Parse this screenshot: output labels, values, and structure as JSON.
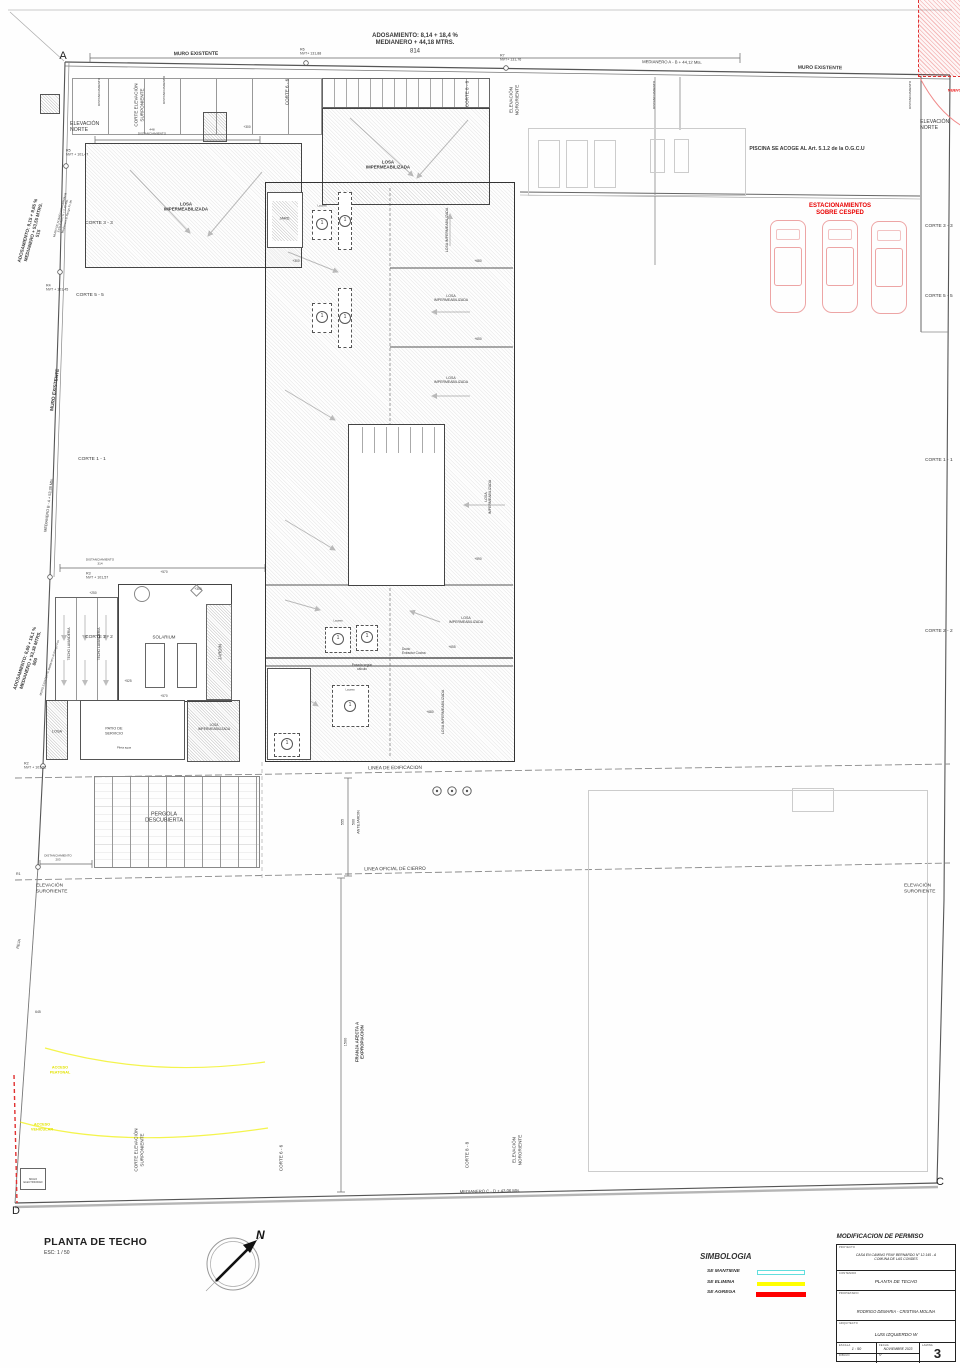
{
  "sheet": {
    "plan_title": "PLANTA DE TECHO",
    "plan_scale": "ESC: 1 / 50",
    "compass_n": "N",
    "corner_markers": {
      "a": "A",
      "c": "C",
      "d": "D"
    }
  },
  "legend": {
    "title": "SIMBOLOGIA",
    "items": [
      {
        "label": "SE MANTIENE",
        "color": "#62dede",
        "style": "outline"
      },
      {
        "label": "SE ELIMINA",
        "color": "#ffff00",
        "style": "solid"
      },
      {
        "label": "SE AGREGA",
        "color": "#ff0000",
        "style": "solid"
      }
    ]
  },
  "titleblock": {
    "header": "MODIFICACION DE PERMISO",
    "fields": {
      "proyecto_label": "PROYECTO",
      "proyecto": "CASA EN CAMINO FRAY BERNARDO  N° 12.145 - A\nCOMUNA DE LAS CONDES",
      "contenido_label": "CONTENIDO",
      "contenido": "PLANTA  DE TECHO",
      "propietario_label": "PROPIETARIO",
      "propietario": "RODRIGO DEMARIA - CRISTINA MOLINA",
      "arquitecto_label": "ARQUITECTO",
      "arquitecto": "LUIS IZQUIERDO W",
      "escala_label": "ESCALA",
      "escala": "1 : 50",
      "fecha_label": "FECHA",
      "fecha": "NOVIEMBRE  2023",
      "lamina_label": "LAMINA",
      "lamina": "3",
      "dibujo_label": "DIBUJO",
      "num_label": "N°"
    }
  },
  "annotations": [
    {
      "t": "ADOSAMIENTO: 8,14 + 18,4 %\nMEDIANERO + 44,18 MTRS.",
      "x": 415,
      "y": 40,
      "s": 6,
      "b": 1
    },
    {
      "t": "814",
      "x": 415,
      "y": 52,
      "s": 6
    },
    {
      "t": "MURO EXISTENTE",
      "x": 196,
      "y": 54,
      "s": 5,
      "b": 1,
      "r": -0.5
    },
    {
      "t": "R6\nNVT+ 131,88",
      "x": 300,
      "y": 52,
      "s": 3.6,
      "a": "l"
    },
    {
      "t": "R7\nNVT+ 131,76",
      "x": 500,
      "y": 58,
      "s": 3.6,
      "a": "l"
    },
    {
      "t": "MEDIANERO A - B + 44,12 Mts.",
      "x": 672,
      "y": 62,
      "s": 4.2,
      "r": 0.8
    },
    {
      "t": "MURO EXISTENTE",
      "x": 820,
      "y": 68,
      "s": 5,
      "b": 1,
      "r": 0.8
    },
    {
      "t": "CORTE ELEVACIÓN\nSURPONIENTE",
      "x": 139,
      "y": 105,
      "s": 4.6,
      "r": -90
    },
    {
      "t": "CORTE 6 - 6",
      "x": 287,
      "y": 92,
      "s": 4.6,
      "r": -90
    },
    {
      "t": "CORTE 8 - 8",
      "x": 467,
      "y": 94,
      "s": 4.6,
      "r": -90
    },
    {
      "t": "ELEVACIÓN\nNORORIENTE",
      "x": 514,
      "y": 100,
      "s": 4.6,
      "r": -90
    },
    {
      "t": "ELEVACIÓN\nNORTE",
      "x": 70,
      "y": 127,
      "s": 5.2,
      "a": "l"
    },
    {
      "t": "R5\nNVT + 101,47",
      "x": 66,
      "y": 153,
      "s": 3.6,
      "a": "l"
    },
    {
      "t": "DISTANCIAMIENTO",
      "x": 100,
      "y": 92,
      "s": 3.1,
      "r": -90
    },
    {
      "t": "DISTANCIAMIENTO",
      "x": 165,
      "y": 90,
      "s": 3.1,
      "r": -90
    },
    {
      "t": "448\nDISTANCIAMIENTO",
      "x": 152,
      "y": 132,
      "s": 3.1
    },
    {
      "t": "DISTANCIAMIENTO",
      "x": 655,
      "y": 95,
      "s": 3.1,
      "r": -90
    },
    {
      "t": "DISTANCIAMIENTO",
      "x": 911,
      "y": 95,
      "s": 3.1,
      "r": -90
    },
    {
      "t": "PISCINA SE ACOGE AL Art. 5.1.2 de la O.G.C.U",
      "x": 807,
      "y": 149,
      "s": 5.2,
      "b": 1
    },
    {
      "t": "ELEVACIÓN\nNORTE",
      "x": 920,
      "y": 125,
      "s": 5.2,
      "a": "l"
    },
    {
      "t": "ESTACIONAMIENTOS\nSOBRE CESPED",
      "x": 840,
      "y": 210,
      "s": 6,
      "b": 1,
      "c": "#e80000"
    },
    {
      "t": "NUEVO",
      "x": 948,
      "y": 91,
      "s": 3.8,
      "b": 1,
      "c": "#e80000",
      "a": "l"
    },
    {
      "t": "CORTE 3 - 3",
      "x": 925,
      "y": 227,
      "s": 4.8,
      "a": "l"
    },
    {
      "t": "CORTE 5 - 5",
      "x": 925,
      "y": 297,
      "s": 4.8,
      "a": "l"
    },
    {
      "t": "CORTE 1 - 1",
      "x": 925,
      "y": 461,
      "s": 4.8,
      "a": "l"
    },
    {
      "t": "CORTE 2 - 2",
      "x": 925,
      "y": 632,
      "s": 4.8,
      "a": "l"
    },
    {
      "t": "ADOSAMIENTO: 9,15 + 9,65 %\nMEDIANERO + 53,55 MTRS.\n515",
      "x": 33,
      "y": 232,
      "s": 4.6,
      "b": 1,
      "r": -75
    },
    {
      "t": "MURO DE ALBAÑILERIA ARMADA\nESTUCADO H = 2,20 Mts.\nMedianero al Rango Fc Mt",
      "x": 64,
      "y": 216,
      "s": 2.9,
      "r": -75
    },
    {
      "t": "CORTE 3 - 3",
      "x": 99,
      "y": 224,
      "s": 4.8
    },
    {
      "t": "R4\nNVT + 101,45",
      "x": 46,
      "y": 288,
      "s": 3.6,
      "a": "l"
    },
    {
      "t": "CORTE 5 - 5",
      "x": 90,
      "y": 296,
      "s": 4.8
    },
    {
      "t": "MURO EXISTENTE",
      "x": 56,
      "y": 390,
      "s": 4.8,
      "b": 1,
      "r": -82
    },
    {
      "t": "CORTE 1 - 1",
      "x": 92,
      "y": 460,
      "s": 4.8
    },
    {
      "t": "MEDIANERO B - A + 53,38 Mts.",
      "x": 49,
      "y": 505,
      "s": 3.8,
      "r": -83
    },
    {
      "t": "DISTANCIAMIENTO\n314",
      "x": 100,
      "y": 562,
      "s": 3.1
    },
    {
      "t": "R3\nNVT + 101,57",
      "x": 86,
      "y": 576,
      "s": 3.6,
      "a": "l"
    },
    {
      "t": "ADOSAMIENTO: 8,69 + 18,1 %\nMEDIANERO + 53,38 MTRS.\n860",
      "x": 30,
      "y": 660,
      "s": 4.6,
      "b": 1,
      "r": -72
    },
    {
      "t": "MURO EXISTENTE Medianero al Rango Fos",
      "x": 50,
      "y": 668,
      "s": 2.9,
      "r": -72
    },
    {
      "t": "CORTE 2 - 2",
      "x": 99,
      "y": 638,
      "s": 4.8
    },
    {
      "t": "R2\nNVT + 101,52",
      "x": 24,
      "y": 766,
      "s": 3.6,
      "a": "l"
    },
    {
      "t": "LOSA\nIMPERMEABILIZADA",
      "x": 186,
      "y": 207,
      "s": 4.4,
      "b": 1
    },
    {
      "t": "LOSA\nIMPERMEABILIZADA",
      "x": 388,
      "y": 165,
      "s": 4.4,
      "b": 1
    },
    {
      "t": "+300",
      "x": 247,
      "y": 128,
      "s": 3.2
    },
    {
      "t": "+300",
      "x": 296,
      "y": 262,
      "s": 3.2
    },
    {
      "t": "JARD.",
      "x": 285,
      "y": 219,
      "s": 3.8
    },
    {
      "t": "Lucarna",
      "x": 322,
      "y": 206,
      "s": 2.5
    },
    {
      "t": "LOSA IMPERMEABILIZADA",
      "x": 447,
      "y": 230,
      "s": 3.5,
      "r": -90
    },
    {
      "t": "LOSA\nIMPERMEABILIZADA",
      "x": 451,
      "y": 298,
      "s": 3.5
    },
    {
      "t": "+680",
      "x": 478,
      "y": 262,
      "s": 3.2
    },
    {
      "t": "LOSA\nIMPERMEABILIZADA",
      "x": 451,
      "y": 380,
      "s": 3.5
    },
    {
      "t": "+650",
      "x": 478,
      "y": 340,
      "s": 3.2
    },
    {
      "t": "LOSA\nIMPERMEABILIZADA",
      "x": 488,
      "y": 497,
      "s": 3.5,
      "r": -90
    },
    {
      "t": "+590",
      "x": 478,
      "y": 560,
      "s": 3.2
    },
    {
      "t": "LOSA\nIMPERMEABILIZADA",
      "x": 466,
      "y": 620,
      "s": 3.5
    },
    {
      "t": "LOSA IMPERMEABILIZADA",
      "x": 443,
      "y": 712,
      "s": 3.5,
      "r": -90
    },
    {
      "t": "Lucarna",
      "x": 338,
      "y": 621,
      "s": 2.5
    },
    {
      "t": "Lucarna",
      "x": 350,
      "y": 690,
      "s": 2.5
    },
    {
      "t": "Ducto\nExtractor Cocina",
      "x": 402,
      "y": 652,
      "s": 3.2,
      "a": "l"
    },
    {
      "t": "Pasada según\ncálculo",
      "x": 362,
      "y": 668,
      "s": 3.2
    },
    {
      "t": "+655",
      "x": 452,
      "y": 648,
      "s": 3.2
    },
    {
      "t": "+680",
      "x": 430,
      "y": 713,
      "s": 3.2
    },
    {
      "t": "SOLARIUM",
      "x": 164,
      "y": 637,
      "s": 4.4
    },
    {
      "t": "JARDIN",
      "x": 220,
      "y": 652,
      "s": 4.4,
      "r": -90
    },
    {
      "t": "TECHO LAVANDERIA",
      "x": 70,
      "y": 644,
      "s": 3.3,
      "r": -90
    },
    {
      "t": "TECHO LAVANDERIA",
      "x": 100,
      "y": 644,
      "s": 3.3,
      "r": -90
    },
    {
      "t": "+570",
      "x": 164,
      "y": 573,
      "s": 3.2
    },
    {
      "t": "+570",
      "x": 164,
      "y": 697,
      "s": 3.2
    },
    {
      "t": "+300",
      "x": 198,
      "y": 590,
      "s": 3.2
    },
    {
      "t": "+250",
      "x": 93,
      "y": 594,
      "s": 3.2
    },
    {
      "t": "+525",
      "x": 128,
      "y": 682,
      "s": 3.2
    },
    {
      "t": "LOSA",
      "x": 57,
      "y": 732,
      "s": 3.8
    },
    {
      "t": "PATIO DE\nSERVICIO",
      "x": 114,
      "y": 731,
      "s": 3.8
    },
    {
      "t": "LOSA\nIMPERMEABILIZADA",
      "x": 214,
      "y": 728,
      "s": 3.3
    },
    {
      "t": "Pileta agua",
      "x": 124,
      "y": 748,
      "s": 2.8
    },
    {
      "t": "LINEA DE EDIFICACION",
      "x": 395,
      "y": 769,
      "s": 4.8,
      "r": -0.5
    },
    {
      "t": "PERGOLA\nDESCUBIERTA",
      "x": 164,
      "y": 818,
      "s": 5.4
    },
    {
      "t": "555",
      "x": 343,
      "y": 822,
      "s": 3.8,
      "r": -90
    },
    {
      "t": "500\nANTEJARDIN",
      "x": 356,
      "y": 822,
      "s": 3.8,
      "r": -90
    },
    {
      "t": "LINEA OFICIAL DE CIERRO",
      "x": 395,
      "y": 870,
      "s": 4.8,
      "r": -0.5
    },
    {
      "t": "DISTANCIAMIENTO\n203",
      "x": 58,
      "y": 858,
      "s": 3
    },
    {
      "t": "R1",
      "x": 16,
      "y": 874,
      "s": 3.6,
      "a": "l"
    },
    {
      "t": "ELEVACIÓN\nSURORIENTE",
      "x": 36,
      "y": 889,
      "s": 4.8,
      "a": "l"
    },
    {
      "t": "ELEVACIÓN\nSURORIENTE",
      "x": 904,
      "y": 889,
      "s": 4.8,
      "a": "l"
    },
    {
      "t": "REJA",
      "x": 19,
      "y": 944,
      "s": 3.8,
      "r": -78
    },
    {
      "t": "645",
      "x": 38,
      "y": 1012,
      "s": 3.4
    },
    {
      "t": "1500",
      "x": 346,
      "y": 1042,
      "s": 3.8,
      "r": -90
    },
    {
      "t": "FRANJA AFECTA A\nEXPROPIACION",
      "x": 360,
      "y": 1042,
      "s": 4.4,
      "b": 1,
      "r": -90
    },
    {
      "t": "ACCESO\nPEATONAL",
      "x": 60,
      "y": 1070,
      "s": 3.8,
      "b": 1,
      "c": "#e3e300"
    },
    {
      "t": "ACCESO\nVEHICULAR",
      "x": 42,
      "y": 1127,
      "s": 3.8,
      "b": 1,
      "c": "#e3e300"
    },
    {
      "t": "NICHO\nELECTRICIDAD",
      "x": 33,
      "y": 1181,
      "s": 2.6
    },
    {
      "t": "CORTE ELEVACIÓN\nSURPONIENTE",
      "x": 139,
      "y": 1150,
      "s": 4.6,
      "r": -90
    },
    {
      "t": "CORTE 6 - 6",
      "x": 281,
      "y": 1158,
      "s": 4.6,
      "r": -90
    },
    {
      "t": "CORTE 8 - 8",
      "x": 467,
      "y": 1155,
      "s": 4.6,
      "r": -90
    },
    {
      "t": "ELEVACIÓN\nNORORIENTE",
      "x": 517,
      "y": 1150,
      "s": 4.6,
      "r": -90
    },
    {
      "t": "MEDIANERO C - D + 43,06 Mts.",
      "x": 490,
      "y": 1191,
      "s": 4.2,
      "r": -1.2
    }
  ],
  "lucarnas": [
    {
      "x": 322,
      "y": 224,
      "n": "1"
    },
    {
      "x": 345,
      "y": 221,
      "n": "1"
    },
    {
      "x": 322,
      "y": 317,
      "n": "1"
    },
    {
      "x": 345,
      "y": 318,
      "n": "1"
    },
    {
      "x": 338,
      "y": 639,
      "n": "1"
    },
    {
      "x": 367,
      "y": 637,
      "n": "1"
    },
    {
      "x": 350,
      "y": 706,
      "n": "1"
    },
    {
      "x": 287,
      "y": 744,
      "n": "1"
    }
  ]
}
